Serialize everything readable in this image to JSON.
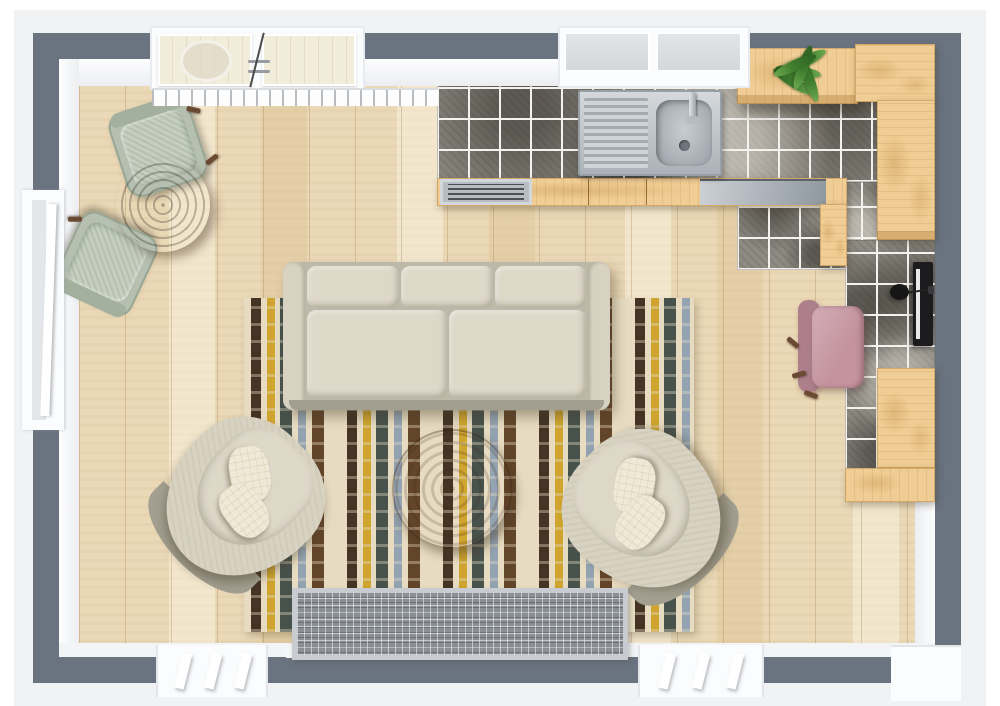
{
  "meta": {
    "description": "Top-down 3D floor plan render of a living room with open L-shaped kitchen, dining nook and desk area",
    "visible_text": []
  },
  "palette": {
    "wall": "#6a7380",
    "wall_outer": "#f0f2f4",
    "floor": "#ead8b6",
    "tile_base": "#8e8b83",
    "grout": "#f3f2ee",
    "cabinet_wood": "#f0cd94",
    "steel_light": "#ccd1d6",
    "steel_dark": "#8f979f",
    "sofa": "#d8d2c2",
    "sofa_shadow": "#a39f90",
    "cushion": "#ded8c9",
    "pillow": "#f0e9d7",
    "rug_cream": "#e7dcc2",
    "rug_darkbrown": "#453325",
    "rug_brown": "#63452a",
    "rug_mustard": "#cfa42f",
    "rug_slate": "#47524d",
    "rug_bluegray": "#93a3b2",
    "coffee_table": "#7c5130",
    "dining_table": "#46342a",
    "dining_chair": "#b5c0b0",
    "office_chair": "#c4939e",
    "office_chair_dark": "#ad7f8b",
    "plant_green": "#3f7d2e",
    "vent_frame": "#c8cbcf",
    "vent_grid": "#8a8f96",
    "monitor_black": "#1c1c1e",
    "door_panel": "#f2ecdb",
    "window_glass": "#d3d7da",
    "chair_leg_brown": "#6b4a33"
  },
  "scene": {
    "rooms": [
      {
        "name": "living-room",
        "floor": "light ash wood planks"
      },
      {
        "name": "kitchen",
        "floor": "gray granite tile with white grout"
      }
    ],
    "furniture": {
      "dining_table": {
        "label": "Round dark wood dining table",
        "seats": 2
      },
      "dining_chair": {
        "label": "Sage upholstered dining chair",
        "count": 2
      },
      "sofa": {
        "label": "Beige 3-seat sofa",
        "back_cushions": 3,
        "seat_cushions": 2
      },
      "armchair": {
        "label": "Beige barrel armchair",
        "count": 2,
        "pillows_each": 2
      },
      "coffee_table": {
        "label": "Round wood coffee table"
      },
      "rug": {
        "label": "Striped wavy area rug",
        "stripe_colors": [
          "#453325",
          "#63452a",
          "#cfa42f",
          "#47524d",
          "#93a3b2",
          "#e7dcc2"
        ]
      },
      "office_chair": {
        "label": "Pink office chair"
      },
      "monitor": {
        "label": "Desktop monitor"
      },
      "desk_lamp": {
        "label": "Black desk lamp"
      },
      "plant": {
        "label": "Potted green plant on wall cabinet"
      },
      "sink": {
        "label": "Stainless kitchen sink with drainboard and faucet"
      },
      "oven": {
        "label": "Stainless oven / range front"
      },
      "dishwasher": {
        "label": "Stainless dishwasher front"
      },
      "cabinets": {
        "label": "Light wood kitchen cabinets (L-shaped run)"
      },
      "floor_vent": {
        "label": "Floor vent / radiator grille"
      }
    },
    "architecture": {
      "walls": {
        "label": "Dark gray exterior walls"
      },
      "patio_door": {
        "label": "Double glazed patio door with threshold",
        "panels": 2
      },
      "kitchen_window": {
        "label": "Kitchen window above sink",
        "panes": 2
      },
      "left_window": {
        "label": "Left wall casement window"
      },
      "bottom_window": {
        "label": "Bottom wall window with mullions",
        "count": 2
      },
      "bottom_right_door": {
        "label": "Door opening at bottom right"
      }
    }
  }
}
